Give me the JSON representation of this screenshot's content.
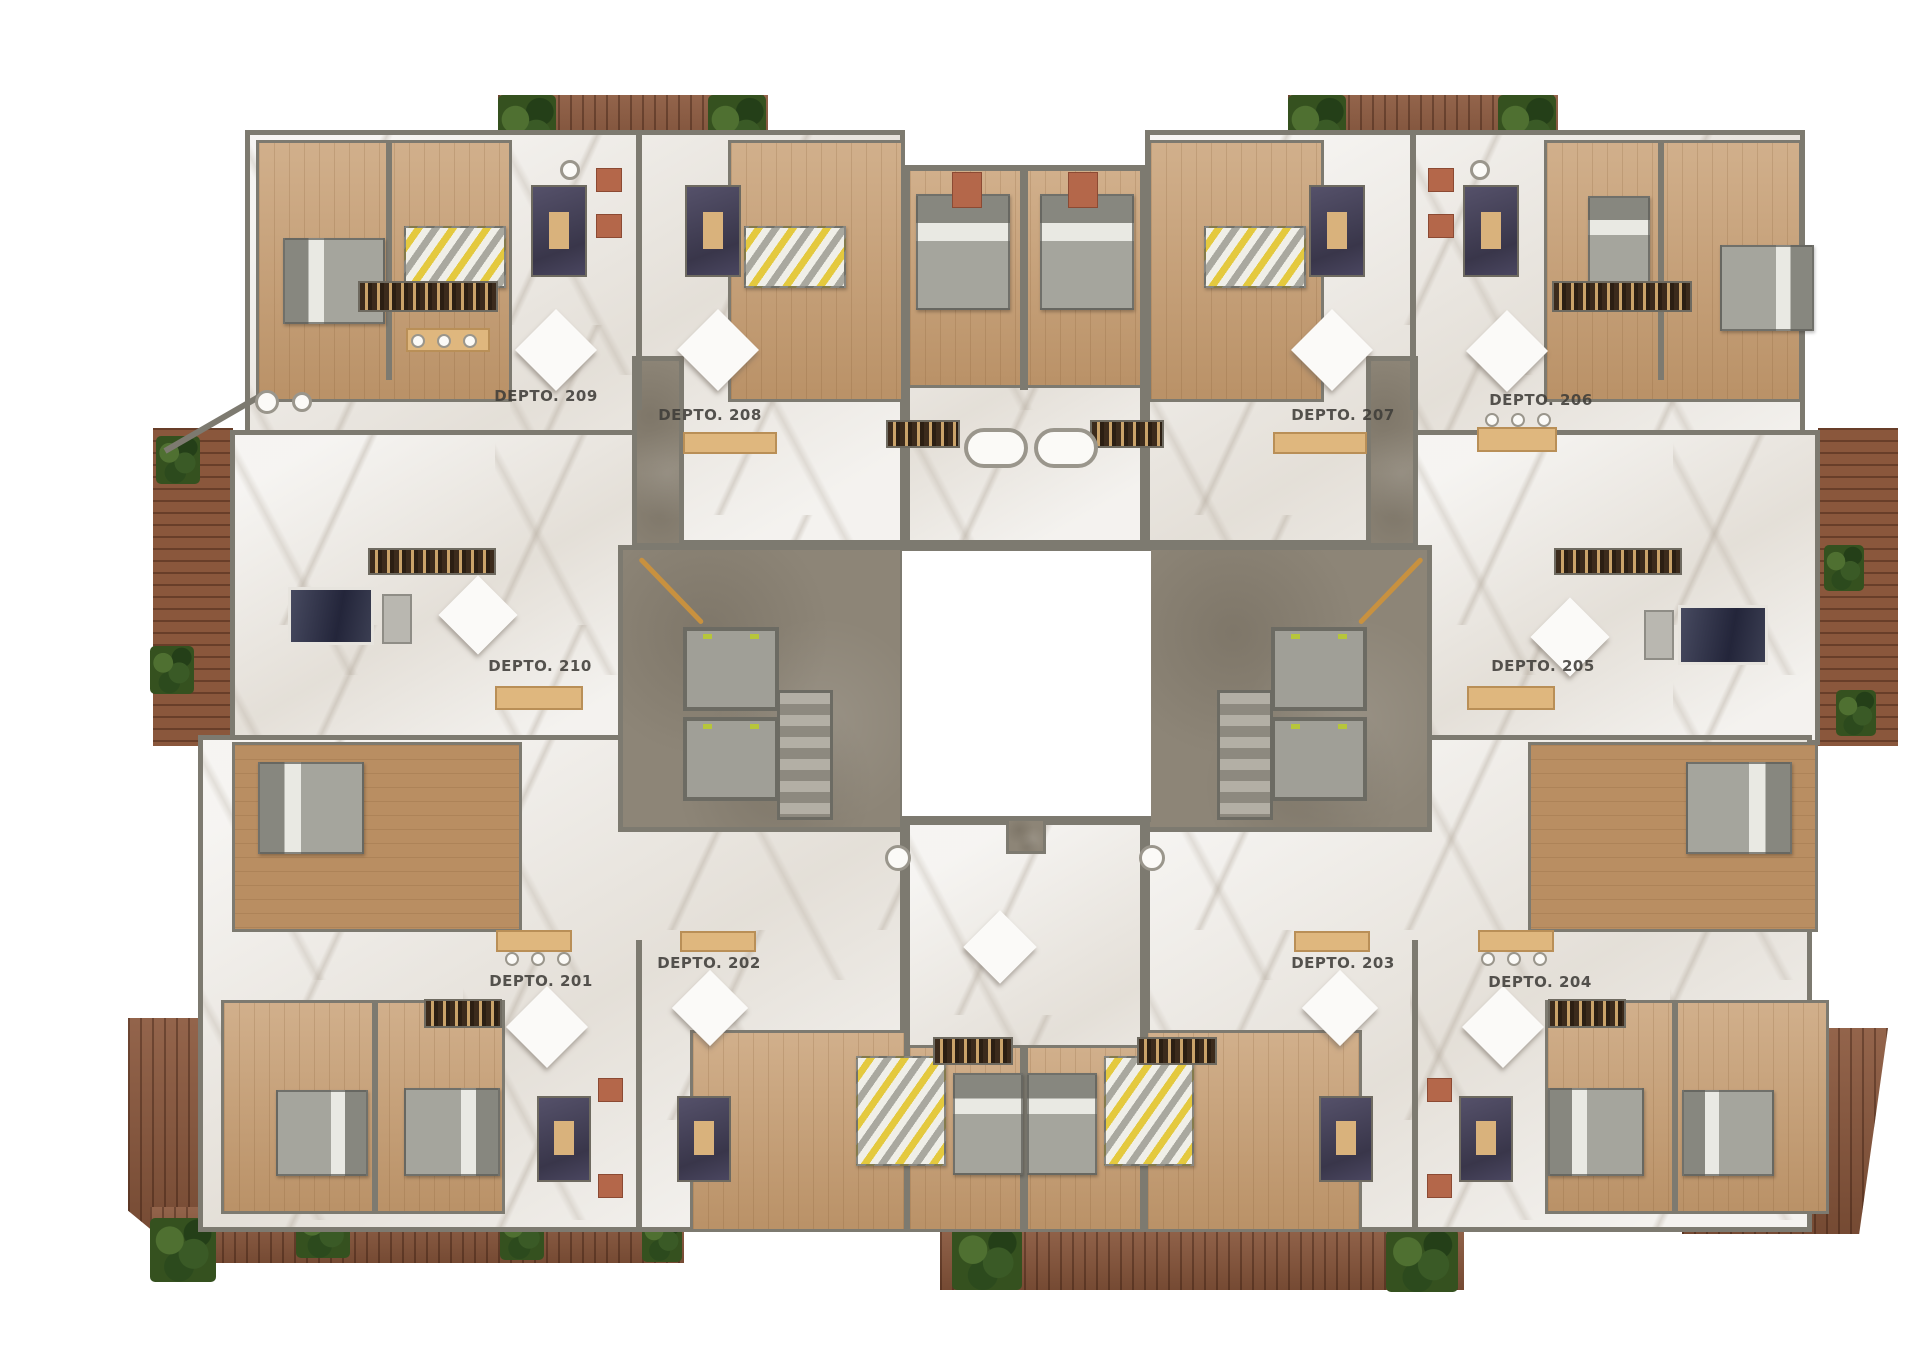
{
  "title": "Apartment floor plan — level 2",
  "units": [
    {
      "id": "201",
      "label": "DEPTO. 201"
    },
    {
      "id": "202",
      "label": "DEPTO. 202"
    },
    {
      "id": "203",
      "label": "DEPTO. 203"
    },
    {
      "id": "204",
      "label": "DEPTO. 204"
    },
    {
      "id": "205",
      "label": "DEPTO. 205"
    },
    {
      "id": "206",
      "label": "DEPTO. 206"
    },
    {
      "id": "207",
      "label": "DEPTO. 207"
    },
    {
      "id": "208",
      "label": "DEPTO. 208"
    },
    {
      "id": "209",
      "label": "DEPTO. 209"
    },
    {
      "id": "210",
      "label": "DEPTO. 210"
    }
  ],
  "colors": {
    "white": "#ffffff",
    "marble": "#edeae5",
    "wood": "#c79e72",
    "wood_dark": "#b98e62",
    "deck": "#8a573c",
    "concrete": "#8d8577",
    "wall": "#7d7a70",
    "plant": "#35511f",
    "bed_yellow": "#e4c93e",
    "terracotta": "#b4674a",
    "bar": "#dfb77e",
    "label": "#3f3d39"
  }
}
